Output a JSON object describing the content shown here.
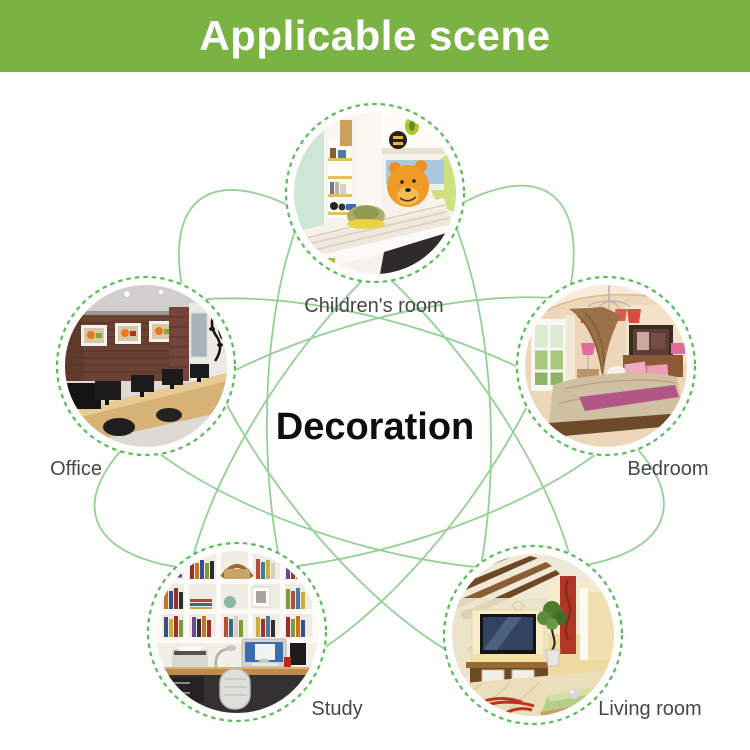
{
  "header": {
    "title": "Applicable scene",
    "bg_color": "#7ab344",
    "text_color": "#ffffff"
  },
  "center": {
    "label": "Decoration",
    "color": "#0e0e0e"
  },
  "diagram": {
    "connector_line_color": "#93d193",
    "dashed_ring_color": "#57bd57",
    "label_color": "#474747",
    "scenes": [
      {
        "id": "children-room",
        "label": "Children's room",
        "position": "top"
      },
      {
        "id": "office",
        "label": "Office",
        "position": "left"
      },
      {
        "id": "bedroom",
        "label": "Bedroom",
        "position": "right"
      },
      {
        "id": "study",
        "label": "Study",
        "position": "bottom-left"
      },
      {
        "id": "living-room",
        "label": "Living room",
        "position": "bottom-right"
      }
    ]
  }
}
